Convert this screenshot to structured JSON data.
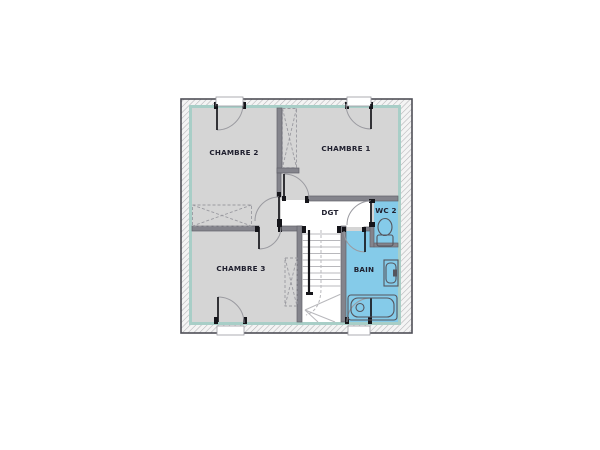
{
  "plan": {
    "labels": {
      "chambre2": "CHAMBRE 2",
      "chambre1": "CHAMBRE 1",
      "chambre3": "CHAMBRE 3",
      "dgt": "DGT",
      "wc2": "WC 2",
      "bain": "BAIN"
    },
    "colors": {
      "wet_room_highlight": "#85cbe9",
      "room_floor": "#d5d5d5",
      "corridor_floor": "#ffffff",
      "interior_wall": "#84848c",
      "insulation_liner": "#a8cec7",
      "outline": "#4f4f57"
    },
    "fixtures": {
      "wc2": [
        "toilet"
      ],
      "bain": [
        "washbasin",
        "bathtub"
      ],
      "circulation": [
        "staircase"
      ],
      "storage": [
        "closet-chambre1",
        "closet-chambre2",
        "closet-chambre3"
      ],
      "openings": [
        "window-chambre2",
        "window-chambre1",
        "window-chambre3",
        "window-bain"
      ]
    }
  }
}
